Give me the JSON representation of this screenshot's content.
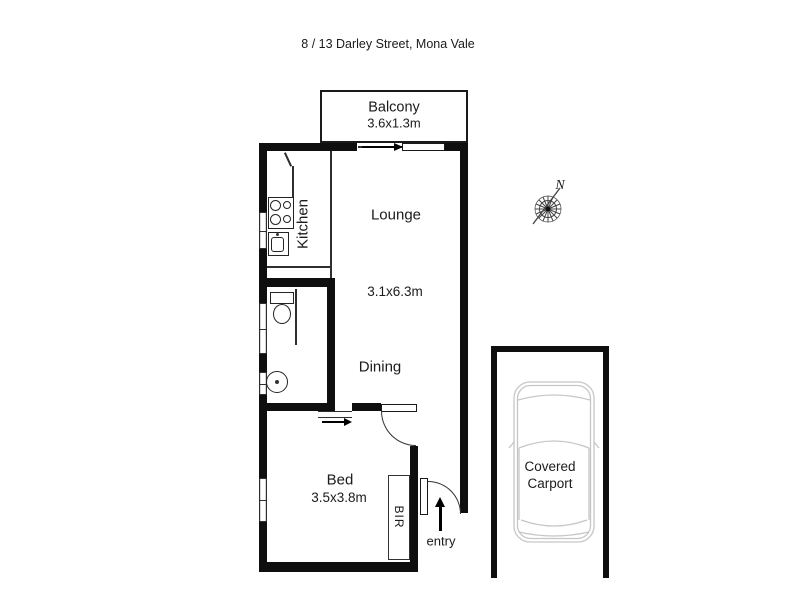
{
  "title": "8 / 13 Darley Street, Mona Vale",
  "floorplan": {
    "balcony": {
      "label": "Balcony",
      "dims": "3.6x1.3m"
    },
    "lounge": {
      "label": "Lounge",
      "dims": "3.1x6.3m"
    },
    "dining": {
      "label": "Dining"
    },
    "kitchen": {
      "label": "Kitchen"
    },
    "bedroom": {
      "label": "Bed",
      "dims": "3.5x3.8m"
    },
    "bir": {
      "label": "BIR"
    },
    "entry": {
      "label": "entry"
    },
    "carport": {
      "line1": "Covered",
      "line2": "Carport"
    },
    "compass": {
      "north": "N"
    }
  },
  "colors": {
    "wall": "#0f0f0f",
    "thin_line": "#2e2e2e",
    "car_outline": "#c6c6c6",
    "text": "#1b1b1b"
  }
}
